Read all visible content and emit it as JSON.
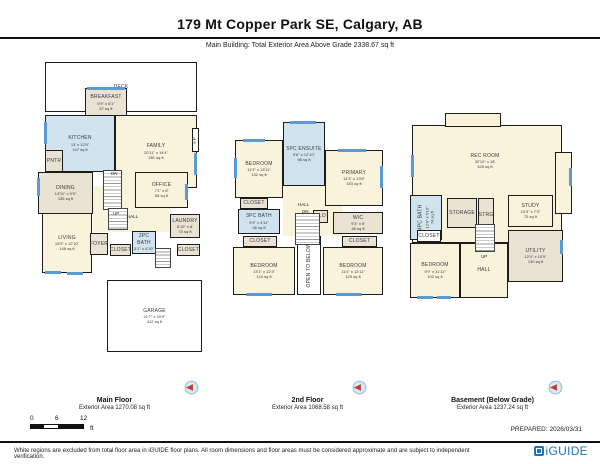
{
  "header": {
    "title": "179 Mt Copper Park SE, Calgary, AB",
    "subtitle": "Main Building: Total Exterior Area Above Grade 2338.67 sq ft"
  },
  "floors": [
    {
      "name": "Main Floor",
      "area_label": "Exterior Area 1270.08 sq ft",
      "rooms": [
        {
          "n": "DECK",
          "x": 30,
          "y": 4,
          "w": 152,
          "h": 50,
          "f": "white"
        },
        {
          "n": "BREAKFAST",
          "d": "9'9\" x 6'1\"",
          "a": "57 sq ft",
          "x": 70,
          "y": 30,
          "w": 42,
          "h": 29,
          "f": "gray"
        },
        {
          "n": "KITCHEN",
          "d": "13' x 12'9\"",
          "a": "147 sq ft",
          "x": 30,
          "y": 57,
          "w": 70,
          "h": 57,
          "f": "blue"
        },
        {
          "n": "FAMILY",
          "d": "20'11\" x 14'4\"",
          "a": "281 sq ft",
          "x": 100,
          "y": 57,
          "w": 82,
          "h": 73,
          "f": "cream"
        },
        {
          "x": 78,
          "y": 128,
          "w": 77,
          "h": 46,
          "f": "cream",
          "nb": true
        },
        {
          "n": "FP",
          "x": 177,
          "y": 70,
          "w": 7,
          "h": 24,
          "f": "white",
          "v": true
        },
        {
          "n": "PNTR",
          "x": 30,
          "y": 92,
          "w": 18,
          "h": 22,
          "f": "gray"
        },
        {
          "n": "DINING",
          "d": "14'11\" x 9'9\"",
          "a": "135 sq ft",
          "x": 23,
          "y": 114,
          "w": 55,
          "h": 42,
          "f": "gray"
        },
        {
          "n": "OFFICE",
          "d": "7'1\" x 8'",
          "a": "55 sq ft",
          "x": 120,
          "y": 114,
          "w": 53,
          "h": 36,
          "f": "cream"
        },
        {
          "n": "LIVING",
          "d": "15'9\" x 12'10\"",
          "a": "148 sq ft",
          "x": 27,
          "y": 155,
          "w": 50,
          "h": 60,
          "f": "cream"
        },
        {
          "n": "LAUNDRY",
          "d": "8'10\" x 8'",
          "a": "70 sq ft",
          "x": 155,
          "y": 156,
          "w": 30,
          "h": 24,
          "f": "gray"
        },
        {
          "n": "FOYER",
          "x": 75,
          "y": 175,
          "w": 18,
          "h": 22,
          "f": "gray"
        },
        {
          "n": "CLOSET",
          "x": 95,
          "y": 186,
          "w": 21,
          "h": 12,
          "f": "gray"
        },
        {
          "n": "2PC BATH",
          "d": "5'1\" x 4'10\"",
          "x": 117,
          "y": 173,
          "w": 24,
          "h": 23,
          "f": "blue"
        },
        {
          "n": "CLOSET",
          "x": 162,
          "y": 186,
          "w": 23,
          "h": 12,
          "f": "gray"
        },
        {
          "n": "GARAGE",
          "d": "21'7\" x 20'9\"",
          "a": "412 sq ft",
          "x": 92,
          "y": 222,
          "w": 95,
          "h": 72,
          "f": "white"
        }
      ],
      "windows": [
        {
          "x": 72,
          "y": 29,
          "w": 38,
          "h": 3
        },
        {
          "x": 29,
          "y": 64,
          "w": 3,
          "h": 22
        },
        {
          "x": 179,
          "y": 95,
          "w": 3,
          "h": 22
        },
        {
          "x": 22,
          "y": 120,
          "w": 3,
          "h": 18
        },
        {
          "x": 30,
          "y": 213,
          "w": 16,
          "h": 3
        },
        {
          "x": 52,
          "y": 214,
          "w": 16,
          "h": 3
        },
        {
          "x": 170,
          "y": 126,
          "w": 3,
          "h": 16
        }
      ],
      "stairs": [
        {
          "x": 88,
          "y": 112,
          "w": 19,
          "h": 40
        },
        {
          "x": 93,
          "y": 150,
          "w": 20,
          "h": 22
        },
        {
          "x": 140,
          "y": 190,
          "w": 16,
          "h": 20
        }
      ],
      "labels": [
        {
          "t": "DN",
          "x": 96,
          "y": 113
        },
        {
          "t": "UP",
          "x": 98,
          "y": 153
        },
        {
          "t": "HALL",
          "x": 112,
          "y": 156
        }
      ]
    },
    {
      "name": "2nd Floor",
      "area_label": "Exterior Area 1068.58 sq ft",
      "rooms": [
        {
          "x": 55,
          "y": 66,
          "w": 60,
          "h": 52,
          "f": "cream",
          "nb": true
        },
        {
          "n": "5PC ENSUITE",
          "d": "9'6\" x 12'10\"",
          "a": "98 sq ft",
          "x": 55,
          "y": 4,
          "w": 42,
          "h": 64,
          "f": "blue"
        },
        {
          "n": "BEDROOM",
          "d": "11'3\" x 13'11\"",
          "a": "132 sq ft",
          "x": 7,
          "y": 22,
          "w": 48,
          "h": 58,
          "f": "cream"
        },
        {
          "n": "PRIMARY",
          "d": "14'3\" x 13'6\"",
          "a": "183 sq ft",
          "x": 97,
          "y": 32,
          "w": 58,
          "h": 56,
          "f": "cream"
        },
        {
          "n": "CLOSET",
          "x": 12,
          "y": 80,
          "w": 28,
          "h": 11,
          "f": "gray"
        },
        {
          "n": "3PC BATH",
          "d": "9'3\" x 4'11\"",
          "a": "46 sq ft",
          "x": 10,
          "y": 91,
          "w": 42,
          "h": 25,
          "f": "blue"
        },
        {
          "n": "CLO",
          "x": 85,
          "y": 92,
          "w": 15,
          "h": 13,
          "f": "gray"
        },
        {
          "n": "WIC",
          "d": "9'3\" x 5'",
          "a": "46 sq ft",
          "x": 105,
          "y": 94,
          "w": 50,
          "h": 22,
          "f": "gray"
        },
        {
          "n": "CLOSET",
          "x": 15,
          "y": 118,
          "w": 34,
          "h": 11,
          "f": "gray"
        },
        {
          "n": "CLOSET",
          "x": 114,
          "y": 118,
          "w": 35,
          "h": 11,
          "f": "gray"
        },
        {
          "n": "BEDROOM",
          "d": "13'1\" x 12'3\"",
          "a": "144 sq ft",
          "x": 5,
          "y": 129,
          "w": 62,
          "h": 48,
          "f": "cream"
        },
        {
          "n": "BEDROOM",
          "d": "11'4\" x 12'11\"",
          "a": "129 sq ft",
          "x": 95,
          "y": 129,
          "w": 60,
          "h": 48,
          "f": "cream"
        },
        {
          "n": "OPEN TO BELOW",
          "x": 69,
          "y": 118,
          "w": 24,
          "h": 59,
          "f": "white",
          "v": true
        }
      ],
      "windows": [
        {
          "x": 62,
          "y": 3,
          "w": 26,
          "h": 3
        },
        {
          "x": 6,
          "y": 40,
          "w": 3,
          "h": 20
        },
        {
          "x": 15,
          "y": 21,
          "w": 22,
          "h": 3
        },
        {
          "x": 110,
          "y": 31,
          "w": 28,
          "h": 3
        },
        {
          "x": 152,
          "y": 48,
          "w": 3,
          "h": 22
        },
        {
          "x": 18,
          "y": 175,
          "w": 26,
          "h": 3
        },
        {
          "x": 108,
          "y": 175,
          "w": 26,
          "h": 3
        }
      ],
      "stairs": [
        {
          "x": 67,
          "y": 95,
          "w": 25,
          "h": 32
        }
      ],
      "labels": [
        {
          "t": "HALL",
          "x": 70,
          "y": 84
        },
        {
          "t": "DN",
          "x": 74,
          "y": 91
        }
      ]
    },
    {
      "name": "Basement (Below Grade)",
      "area_label": "Exterior Area 1237.24 sq ft",
      "rooms": [
        {
          "x": 7,
          "y": 15,
          "w": 150,
          "h": 118,
          "f": "cream"
        },
        {
          "x": 40,
          "y": 3,
          "w": 56,
          "h": 14,
          "f": "cream"
        },
        {
          "x": 150,
          "y": 42,
          "w": 17,
          "h": 62,
          "f": "cream"
        },
        {
          "n": "REC ROOM",
          "d": "32'10\" x 18'",
          "a": "425 sq ft",
          "x": 20,
          "y": 22,
          "w": 120,
          "h": 58,
          "f": "none",
          "nb": true
        },
        {
          "n": "4PC BATH",
          "d": "12'9\" x 5'10\"",
          "a": "74 sq ft",
          "x": 5,
          "y": 85,
          "w": 32,
          "h": 45,
          "f": "blue",
          "v": true
        },
        {
          "n": "STORAGE",
          "x": 42,
          "y": 88,
          "w": 30,
          "h": 30,
          "f": "gray"
        },
        {
          "n": "STRG",
          "x": 73,
          "y": 88,
          "w": 16,
          "h": 34,
          "f": "gray"
        },
        {
          "n": "CLOSET",
          "x": 12,
          "y": 120,
          "w": 24,
          "h": 12,
          "f": "white"
        },
        {
          "n": "BEDROOM",
          "d": "9'9\" x 11'11\"",
          "a": "102 sq ft",
          "x": 5,
          "y": 133,
          "w": 50,
          "h": 55,
          "f": "cream"
        },
        {
          "n": "HALL",
          "x": 55,
          "y": 133,
          "w": 48,
          "h": 55,
          "f": "cream"
        },
        {
          "n": "STUDY",
          "d": "10'3\" x 7'3\"",
          "a": "73 sq ft",
          "x": 103,
          "y": 85,
          "w": 45,
          "h": 32,
          "f": "cream"
        },
        {
          "n": "UTILITY",
          "d": "12'4\" x 10'9\"",
          "a": "130 sq ft",
          "x": 103,
          "y": 120,
          "w": 55,
          "h": 52,
          "f": "gray"
        }
      ],
      "windows": [
        {
          "x": 6,
          "y": 45,
          "w": 3,
          "h": 22
        },
        {
          "x": 164,
          "y": 58,
          "w": 3,
          "h": 18
        },
        {
          "x": 12,
          "y": 186,
          "w": 16,
          "h": 3
        },
        {
          "x": 32,
          "y": 186,
          "w": 14,
          "h": 3
        },
        {
          "x": 155,
          "y": 130,
          "w": 3,
          "h": 14
        }
      ],
      "stairs": [
        {
          "x": 70,
          "y": 114,
          "w": 20,
          "h": 28
        }
      ],
      "labels": [
        {
          "t": "UP",
          "x": 76,
          "y": 144
        }
      ]
    }
  ],
  "scale": {
    "ticks": [
      "0",
      "6",
      "12"
    ],
    "unit": "ft"
  },
  "footer": {
    "prepared": "PREPARED: 2026/03/31",
    "disclaimer": "White regions are excluded from total floor area in iGUIDE floor plans. All room dimensions and floor areas must be considered approximate and are subject to independent verification.",
    "logo_text": "iGUIDE"
  },
  "palette": {
    "cream": "#FAF3DC",
    "blue": "#CFE4EE",
    "gray": "#EAE2D3",
    "white": "#FFFFFF",
    "window": "#5B9BD5",
    "wall": "#1C1C1C",
    "brand_blue": "#1B75BB",
    "compass_red": "#C93A2E"
  }
}
